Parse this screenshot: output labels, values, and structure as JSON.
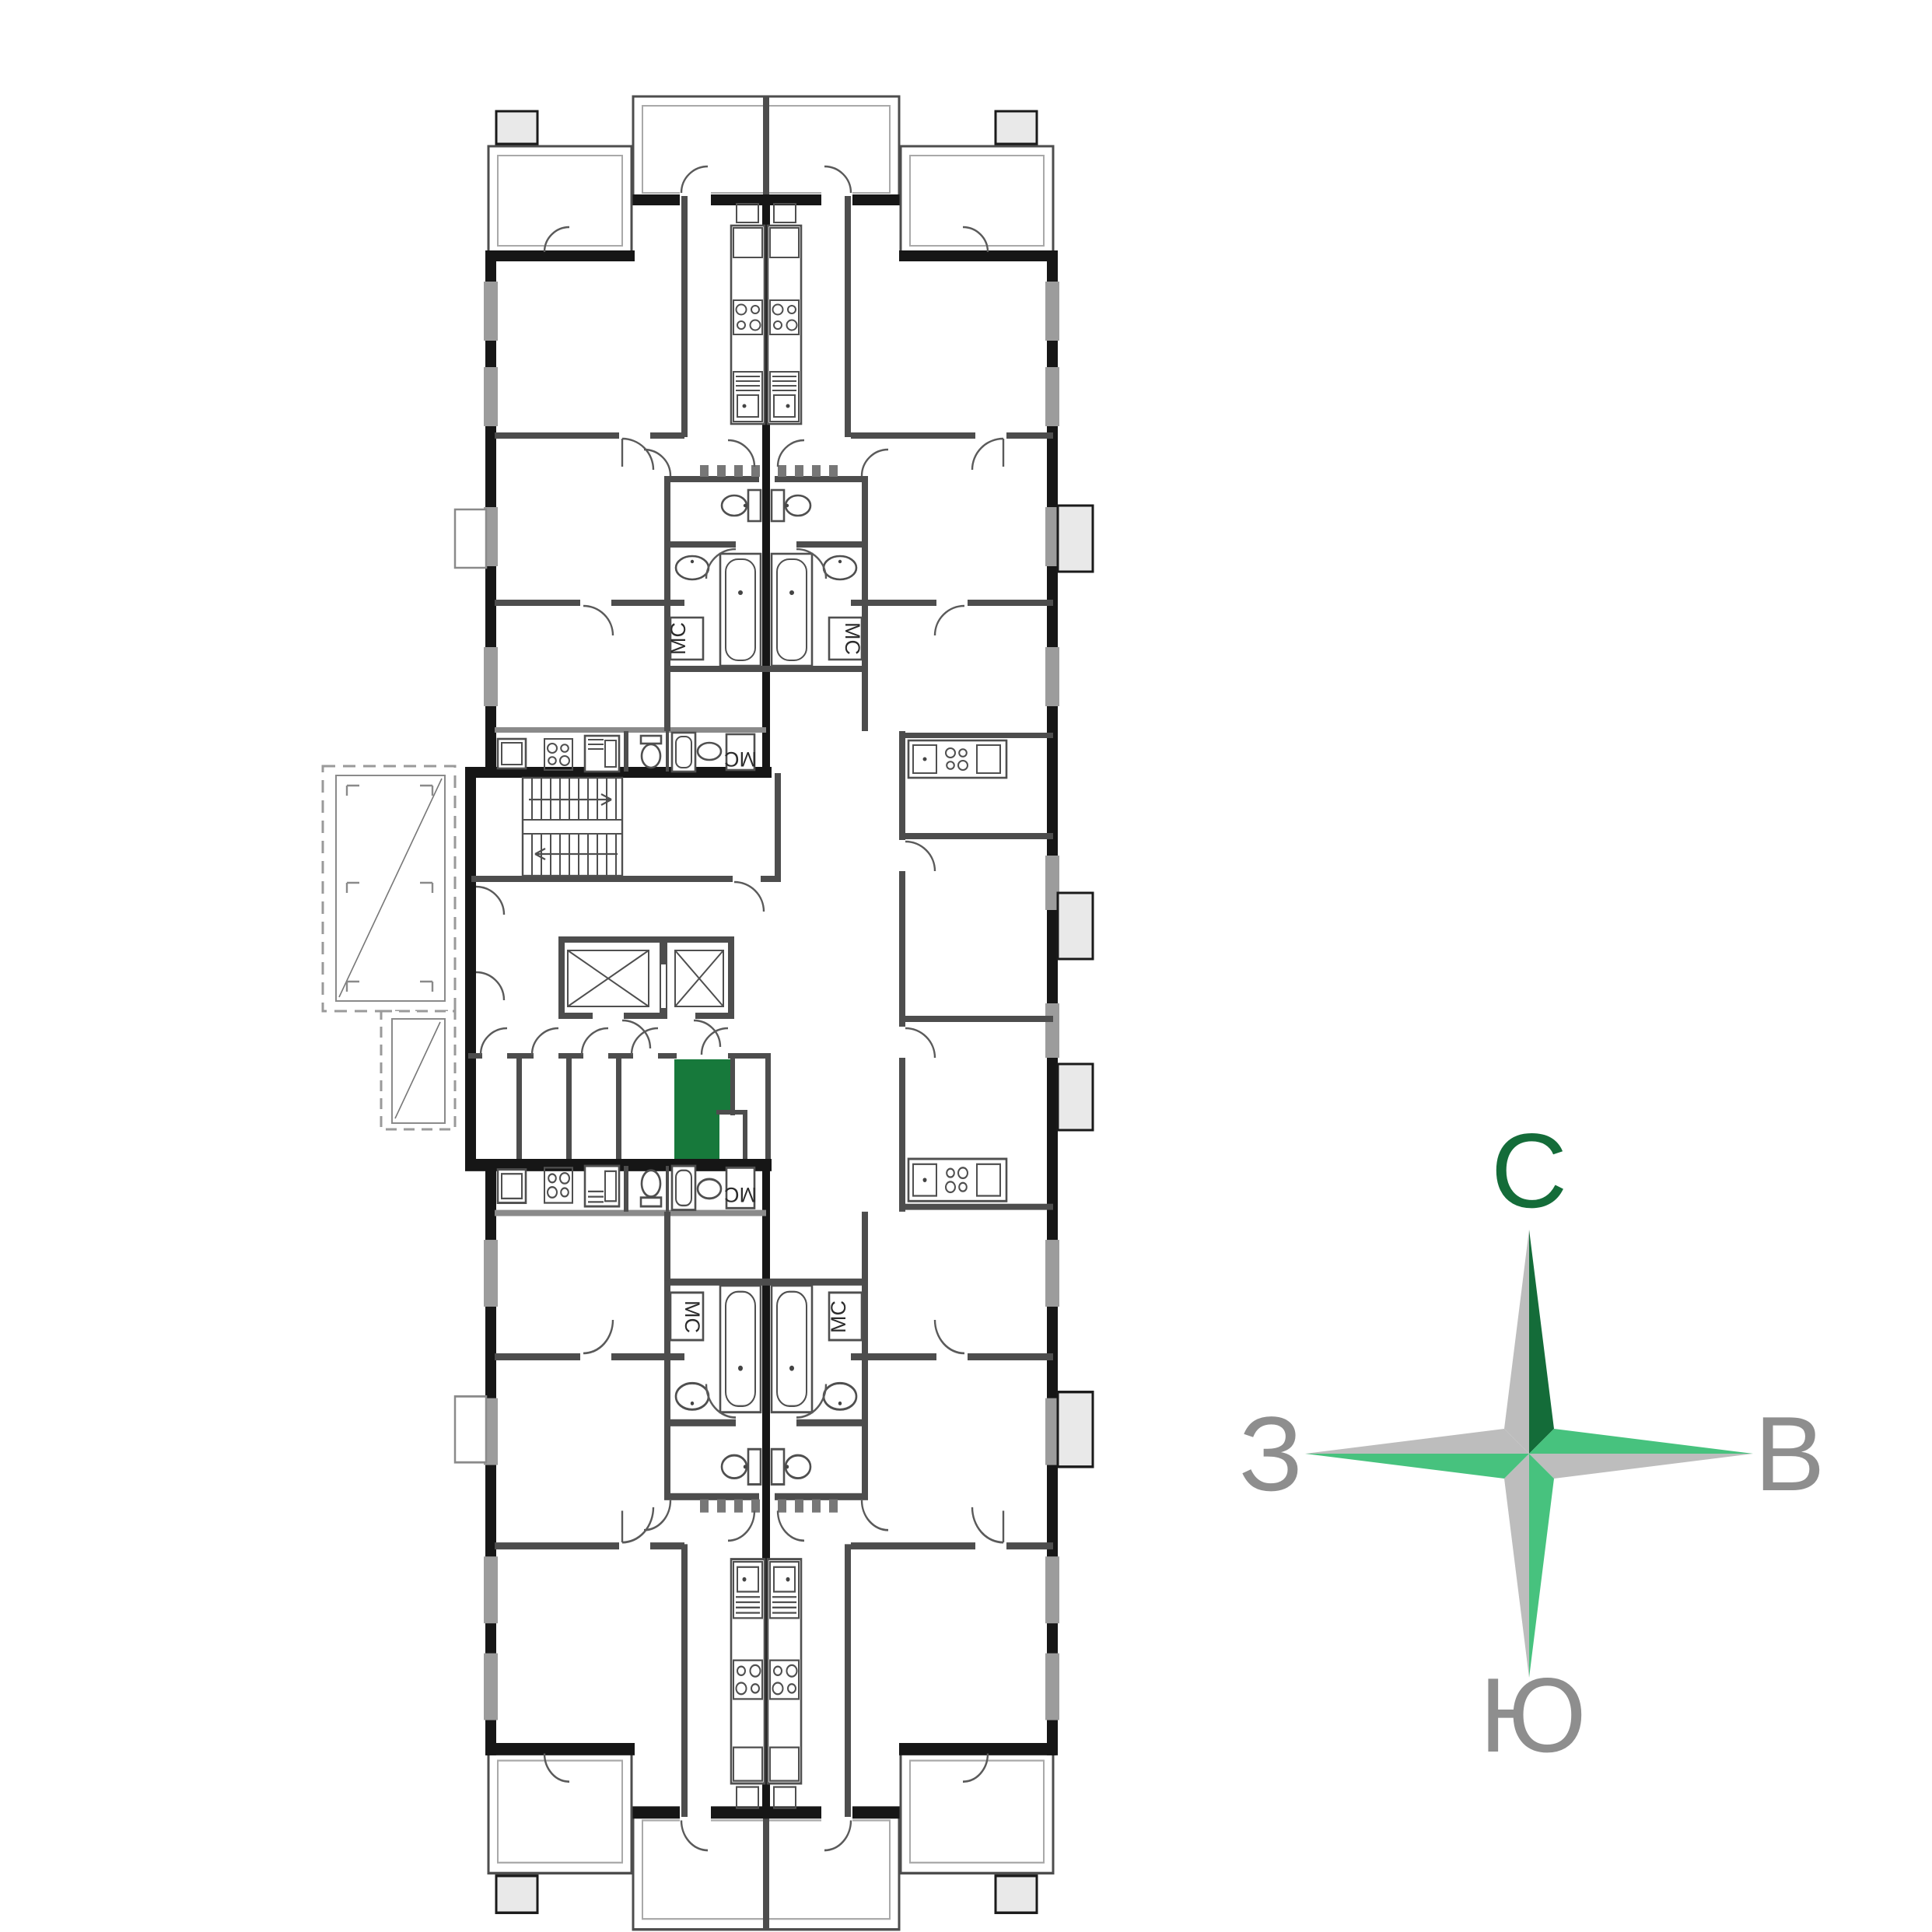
{
  "compass": {
    "north": "С",
    "east": "В",
    "south": "Ю",
    "west": "З",
    "colors": {
      "dark_green": "#146C39",
      "light_green": "#47C27E",
      "star_gray": "#BDBDBD",
      "label_gray": "#8E8E8E"
    }
  },
  "plan": {
    "storage_room_label": "МС",
    "colors": {
      "highlight_green": "#17793B",
      "wall_dark": "#161616",
      "wall_mid": "#4D4D4D",
      "window_gray": "#9C9C9C"
    }
  }
}
